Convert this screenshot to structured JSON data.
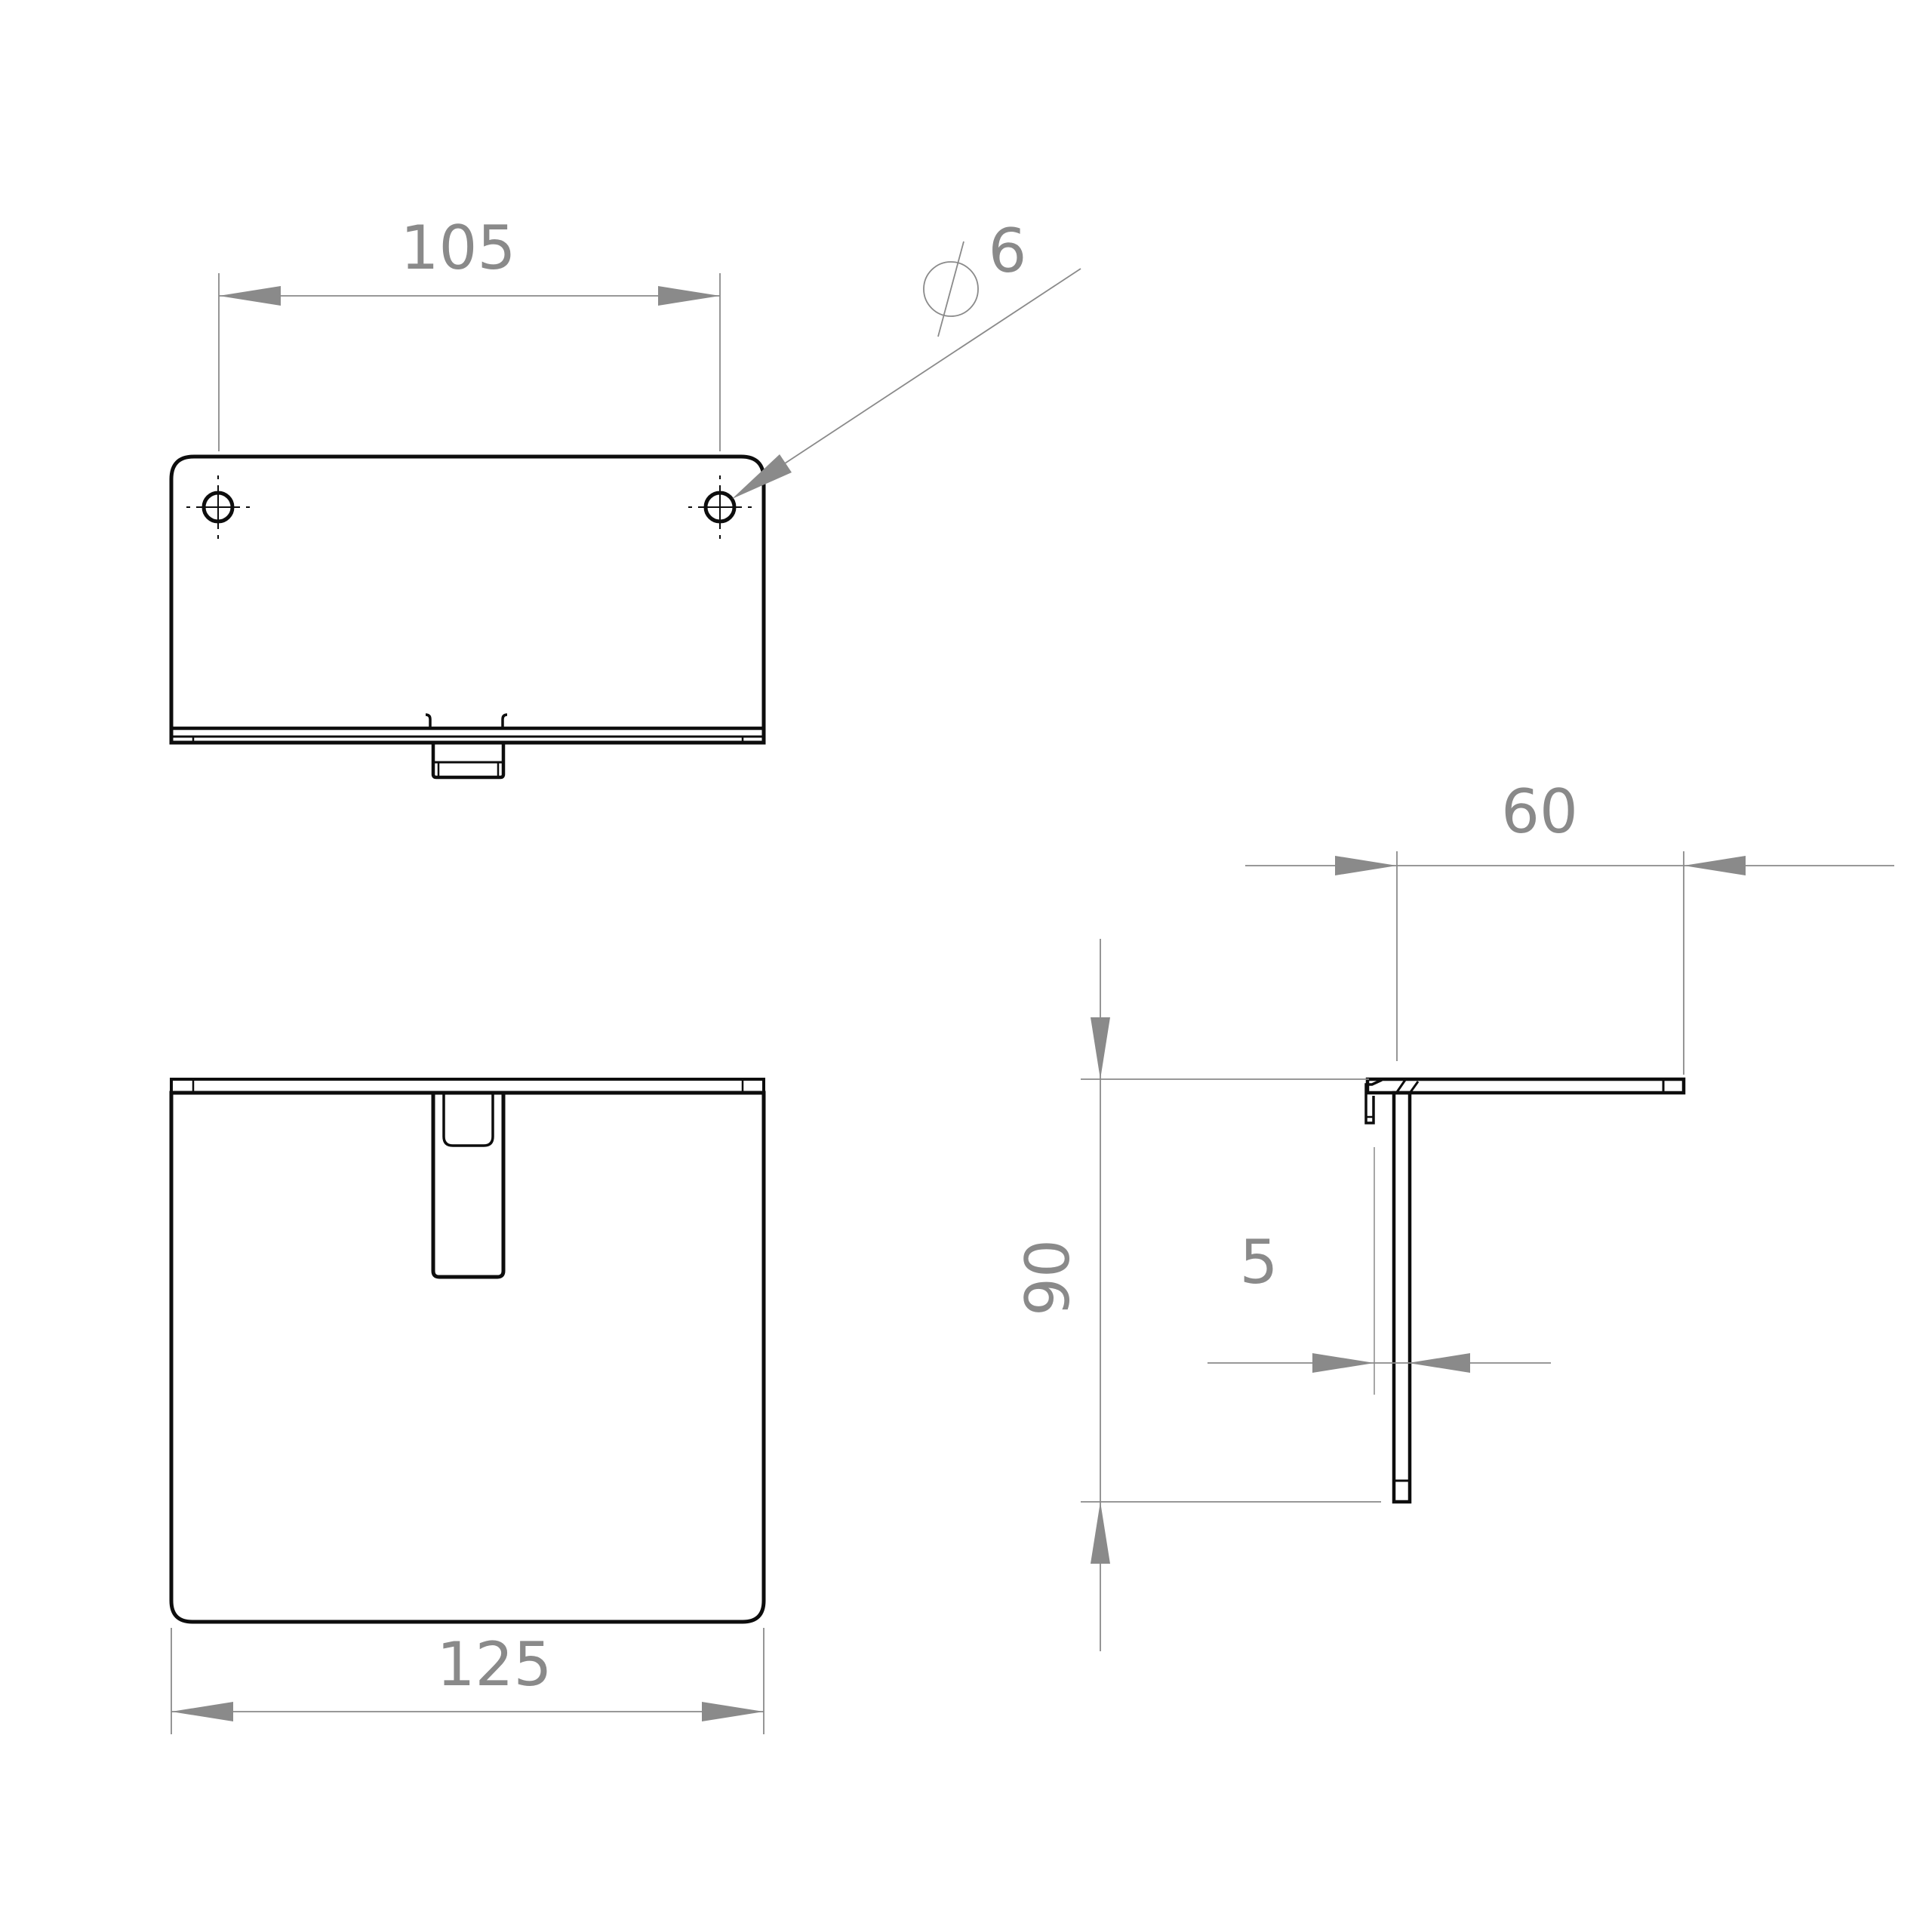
{
  "drawing": {
    "dimensions": {
      "hole_spacing": "105",
      "hole_diameter": "6",
      "overall_width": "125",
      "depth": "60",
      "height": "90",
      "thickness": "5"
    },
    "colors": {
      "outline": "#0d0d0d",
      "dimension": "#8a8a8a",
      "background": "#ffffff"
    }
  }
}
